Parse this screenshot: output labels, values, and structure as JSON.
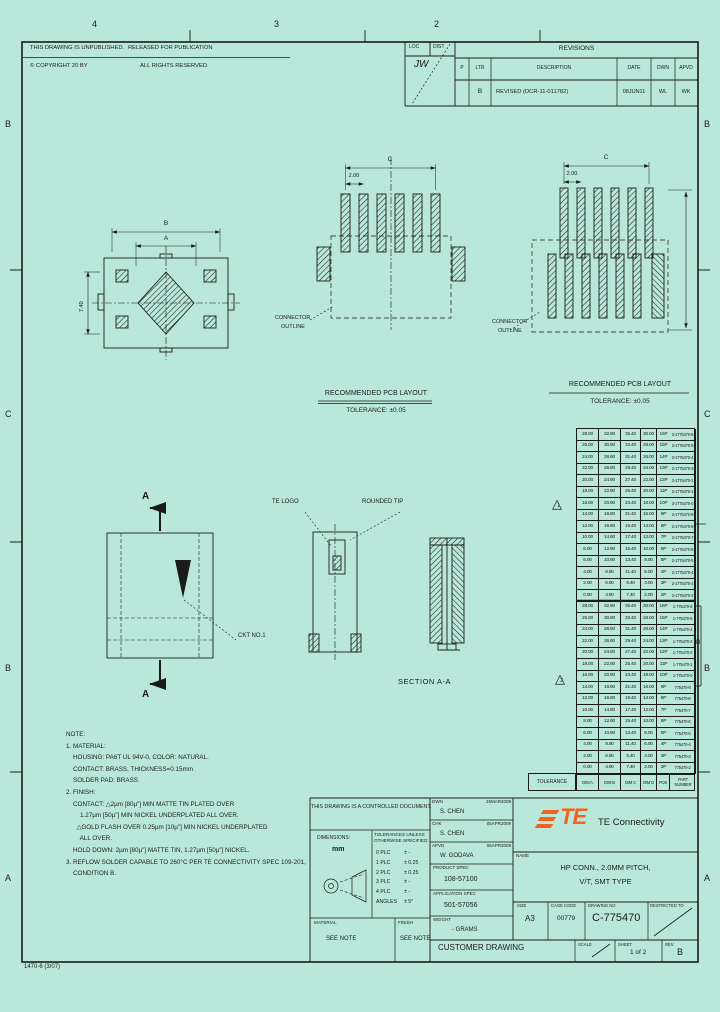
{
  "colors": {
    "paper": "#b9e8da",
    "line": "#1b1b1b",
    "te_orange": "#f26322"
  },
  "margins": {
    "zone_numbers_top": [
      "4",
      "3",
      "2"
    ],
    "zone_letters_left": [
      "B",
      "C",
      "B",
      "A"
    ],
    "zone_letters_right": [
      "B",
      "C",
      "B",
      "A"
    ],
    "form_number": "1470-6 (3/07)"
  },
  "header": {
    "unpublished": "THIS DRAWING IS UNPUBLISHED.",
    "released": "RELEASED FOR PUBLICATION",
    "copyright": "© COPYRIGHT 20    BY    ",
    "rights": "ALL RIGHTS RESERVED.",
    "loc_label": "LOC",
    "dist_label": "DIST",
    "dist_value": "JW"
  },
  "revisions": {
    "title": "REVISIONS",
    "col_p": "P",
    "col_ltr": "LTR",
    "col_desc": "DESCRIPTION",
    "col_date": "DATE",
    "col_dwn": "DWN",
    "col_apvd": "APVD",
    "rows": [
      {
        "ltr": "B",
        "desc": "REVISED (DCR-11-011782)",
        "date": "08JUN11",
        "dwn": "WL",
        "apvd": "WK"
      }
    ]
  },
  "views": {
    "pcb_title": "RECOMMENDED PCB LAYOUT",
    "pcb_tolerance": "TOLERANCE: ±0.05",
    "outline_1": "CONNECTOR",
    "outline_2": "OUTLINE",
    "section": "SECTION  A-A",
    "section_arrow": "A",
    "te_logo": "TE LOGO",
    "rounded_tip": "ROUNDED TIP",
    "ckt_no": "CKT NO.1",
    "dim_pitch": "2.00",
    "dim_span": "C",
    "dim_a": "A",
    "dim_b": "B",
    "dim_height": "7.40",
    "flag_1": "1",
    "flag_2": "2",
    "rev_mark": "B"
  },
  "parts_table": {
    "tol_cell": "TOLERANCE",
    "headers": [
      "DIM A",
      "DIM B",
      "DIM C",
      "DIM D",
      "POS",
      "PART NUMBER"
    ],
    "rows": [
      {
        "a": "28.00",
        "b": "32.90",
        "c": "35.40",
        "d": "30.00",
        "pos": "16P",
        "pn": "3-1775470-6"
      },
      {
        "a": "26.00",
        "b": "30.90",
        "c": "33.40",
        "d": "28.00",
        "pos": "15P",
        "pn": "3-1775470-5"
      },
      {
        "a": "24.00",
        "b": "28.90",
        "c": "31.40",
        "d": "26.00",
        "pos": "14P",
        "pn": "3-1775470-4"
      },
      {
        "a": "22.00",
        "b": "26.90",
        "c": "29.40",
        "d": "24.00",
        "pos": "13P",
        "pn": "3-1775470-3"
      },
      {
        "a": "20.00",
        "b": "24.90",
        "c": "27.40",
        "d": "22.00",
        "pos": "12P",
        "pn": "3-1775470-2"
      },
      {
        "a": "18.00",
        "b": "22.90",
        "c": "25.40",
        "d": "20.00",
        "pos": "11P",
        "pn": "3-1775470-1"
      },
      {
        "a": "16.00",
        "b": "20.90",
        "c": "23.40",
        "d": "18.00",
        "pos": "10P",
        "pn": "3-1775470-0"
      },
      {
        "a": "14.00",
        "b": "18.90",
        "c": "21.40",
        "d": "16.00",
        "pos": "9P",
        "pn": "2-1775470-9"
      },
      {
        "a": "12.00",
        "b": "16.90",
        "c": "19.40",
        "d": "14.00",
        "pos": "8P",
        "pn": "2-1775470-8"
      },
      {
        "a": "10.00",
        "b": "14.90",
        "c": "17.40",
        "d": "12.00",
        "pos": "7P",
        "pn": "2-1775470-7"
      },
      {
        "a": "8.00",
        "b": "12.90",
        "c": "15.40",
        "d": "10.00",
        "pos": "6P",
        "pn": "2-1775470-6"
      },
      {
        "a": "6.00",
        "b": "10.90",
        "c": "13.40",
        "d": "8.00",
        "pos": "5P",
        "pn": "2-1775470-5"
      },
      {
        "a": "4.00",
        "b": "8.90",
        "c": "11.40",
        "d": "6.00",
        "pos": "4P",
        "pn": "2-1775470-4"
      },
      {
        "a": "2.00",
        "b": "6.90",
        "c": "9.40",
        "d": "4.00",
        "pos": "3P",
        "pn": "2-1775470-3"
      },
      {
        "a": "0.00",
        "b": "4.90",
        "c": "7.40",
        "d": "2.00",
        "pos": "2P",
        "pn": "2-1775470-2"
      },
      {
        "a": "28.00",
        "b": "32.90",
        "c": "35.40",
        "d": "30.00",
        "pos": "16P",
        "pn": "1-775470-6"
      },
      {
        "a": "26.00",
        "b": "30.90",
        "c": "33.40",
        "d": "28.00",
        "pos": "15P",
        "pn": "1-775470-5"
      },
      {
        "a": "24.00",
        "b": "28.90",
        "c": "31.40",
        "d": "26.00",
        "pos": "14P",
        "pn": "1-775470-4"
      },
      {
        "a": "22.00",
        "b": "26.90",
        "c": "29.40",
        "d": "24.00",
        "pos": "13P",
        "pn": "1-775470-3"
      },
      {
        "a": "20.00",
        "b": "24.90",
        "c": "27.40",
        "d": "22.00",
        "pos": "12P",
        "pn": "1-775470-2"
      },
      {
        "a": "18.00",
        "b": "22.90",
        "c": "25.40",
        "d": "20.00",
        "pos": "11P",
        "pn": "1-775470-1"
      },
      {
        "a": "16.00",
        "b": "20.90",
        "c": "23.40",
        "d": "18.00",
        "pos": "10P",
        "pn": "1-775470-0"
      },
      {
        "a": "14.00",
        "b": "18.90",
        "c": "21.40",
        "d": "16.00",
        "pos": "9P",
        "pn": "775470-9"
      },
      {
        "a": "12.00",
        "b": "16.90",
        "c": "19.40",
        "d": "14.00",
        "pos": "8P",
        "pn": "775470-8"
      },
      {
        "a": "10.00",
        "b": "14.90",
        "c": "17.40",
        "d": "12.00",
        "pos": "7P",
        "pn": "775470-7"
      },
      {
        "a": "8.00",
        "b": "12.90",
        "c": "15.40",
        "d": "10.00",
        "pos": "6P",
        "pn": "775470-6"
      },
      {
        "a": "6.00",
        "b": "10.90",
        "c": "13.40",
        "d": "8.00",
        "pos": "5P",
        "pn": "775470-5"
      },
      {
        "a": "4.00",
        "b": "8.90",
        "c": "11.40",
        "d": "6.00",
        "pos": "4P",
        "pn": "775470-4"
      },
      {
        "a": "2.00",
        "b": "6.90",
        "c": "9.40",
        "d": "4.00",
        "pos": "3P",
        "pn": "775470-3"
      },
      {
        "a": "0.00",
        "b": "4.90",
        "c": "7.40",
        "d": "2.00",
        "pos": "2P",
        "pn": "775470-2"
      }
    ]
  },
  "notes": {
    "lines": [
      "NOTE:",
      "1. MATERIAL:",
      "    HOUSING: PA6T UL 94V-0, COLOR: NATURAL.",
      "    CONTACT: BRASS, THICKNESS=0.15mm",
      "    SOLDER PAD: BRASS",
      "2. FINISH:",
      "    CONTACT: △2µm [80µ\"] MIN MATTE TIN PLATED OVER",
      "        1.27µm [50µ\"] MIN NICKEL UNDERPLATED ALL OVER.",
      "      △GOLD FLASH OVER 0.25µm [10µ\"] MIN NICKEL UNDERPLATED",
      "        ALL OVER.",
      "    HOLD DOWN: 2µm [80µ\"] MATTE TIN, 1.27µm [50µ\"] NICKEL.",
      "3. REFLOW SOLDER CAPABLE TO 260°C PER TE CONNECTIVITY SPEC 109-201,",
      "    CONDITION B."
    ]
  },
  "doc_block": {
    "controlled": "THIS DRAWING IS A CONTROLLED DOCUMENT.",
    "dimensions_label": "DIMENSIONS:",
    "units": "mm",
    "tol_header_1": "TOLERANCES UNLESS",
    "tol_header_2": "OTHERWISE SPECIFIED:",
    "tolerances": [
      {
        "label": "0 PLC",
        "value": "± -"
      },
      {
        "label": "1 PLC",
        "value": "± 0.25"
      },
      {
        "label": "2 PLC",
        "value": "± 0.25"
      },
      {
        "label": "3 PLC",
        "value": "± -"
      },
      {
        "label": "4 PLC",
        "value": "± -"
      },
      {
        "label": "ANGLES",
        "value": "± 5°"
      }
    ],
    "material_label": "MATERIAL",
    "material": "SEE NOTE",
    "finish_label": "FINISH",
    "finish": "SEE NOTE"
  },
  "title_block": {
    "signatures": [
      {
        "label": "DWN",
        "name": "S. CHEN",
        "date": "26MAR2009"
      },
      {
        "label": "CHK",
        "name": "S. CHEN",
        "date": "05APR2009"
      },
      {
        "label": "APVD",
        "name": "W. GODAVA",
        "date": "06APR2009"
      }
    ],
    "product_spec_label": "PRODUCT SPEC",
    "product_spec": "108-57100",
    "application_spec_label": "APPLICATION SPEC",
    "application_spec": "501-57056",
    "weight_label": "WEIGHT",
    "weight": "- GRAMS",
    "brand": "TE Connectivity",
    "logo_letters": "TE",
    "name_label": "NAME",
    "name_1": "HP CONN., 2.0MM PITCH,",
    "name_2": "V/T, SMT TYPE",
    "size_label": "SIZE",
    "size": "A3",
    "cage_label": "CAGE CODE",
    "cage": "00779",
    "dwg_label": "DRAWING NO",
    "dwg_no": "C-775470",
    "restricted_label": "RESTRICTED TO",
    "doc_type": "CUSTOMER DRAWING",
    "scale_label": "SCALE",
    "sheet_label": "SHEET",
    "sheet": "1 of 2",
    "rev_label": "REV",
    "rev": "B"
  }
}
